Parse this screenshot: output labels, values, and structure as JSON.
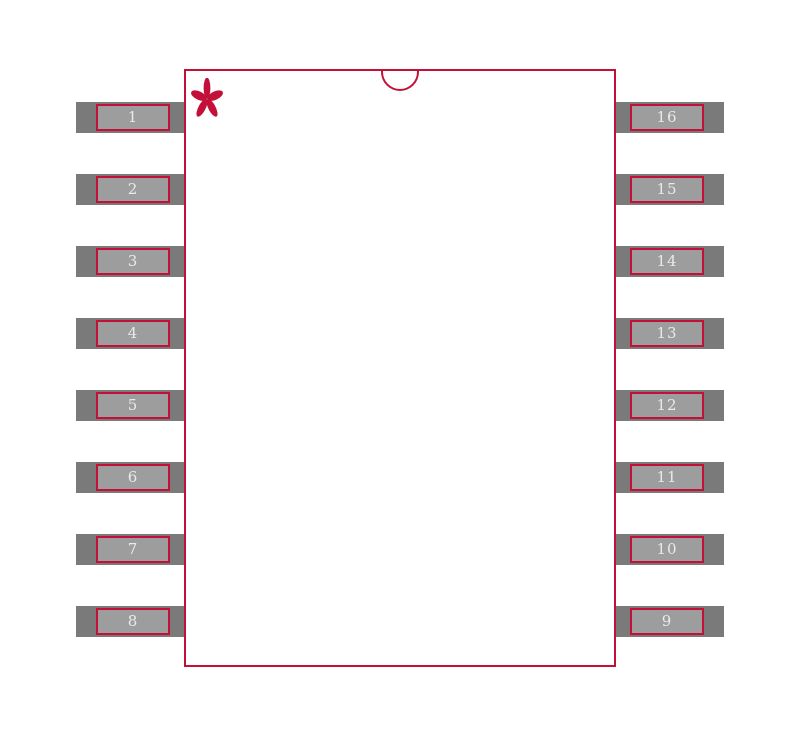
{
  "footprint": {
    "left_pins": [
      "1",
      "2",
      "3",
      "4",
      "5",
      "6",
      "7",
      "8"
    ],
    "right_pins": [
      "16",
      "15",
      "14",
      "13",
      "12",
      "11",
      "10",
      "9"
    ],
    "pin_one_marker_glyph": "*",
    "colors": {
      "outline": "#c31038",
      "pad_fill": "#7a7a7a",
      "lead_fill": "#9d9d9d",
      "pin_number_text": "#eaeaea",
      "background": "#ffffff"
    }
  }
}
